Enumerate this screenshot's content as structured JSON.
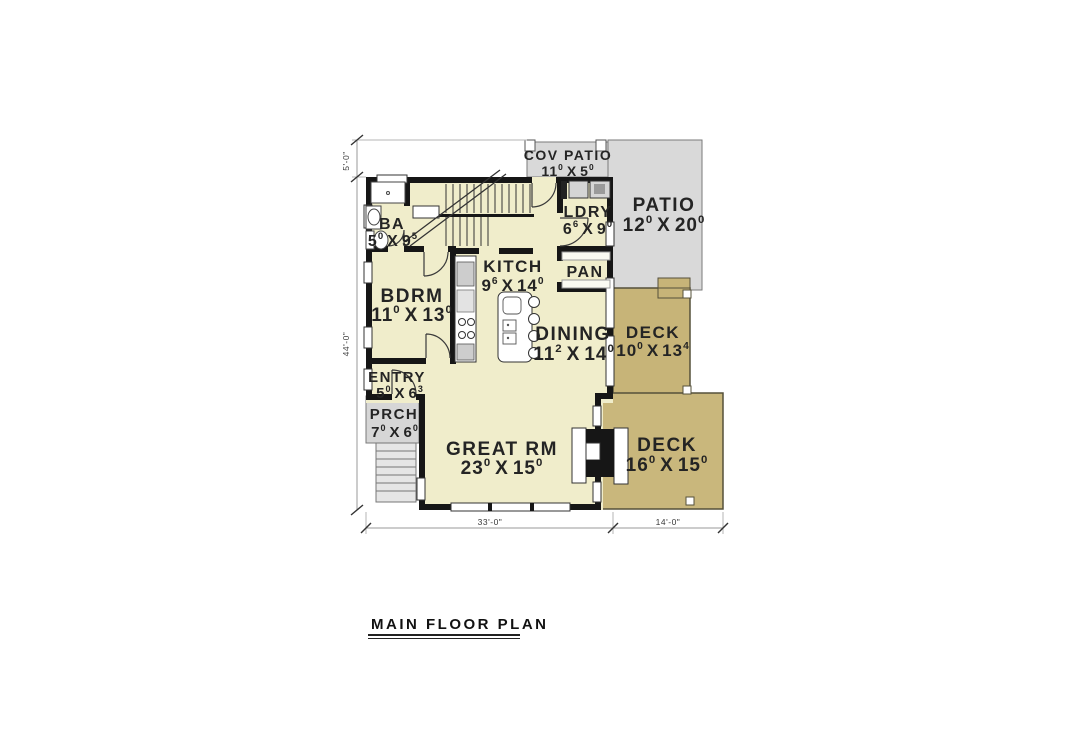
{
  "title": {
    "label": "MAIN FLOOR PLAN"
  },
  "rooms": {
    "cov_patio": {
      "name": "COV PATIO",
      "dim": {
        "w": "11",
        "ws": "0",
        "sep": "X",
        "h": "5",
        "hs": "0"
      }
    },
    "patio": {
      "name": "PATIO",
      "dim": {
        "w": "12",
        "ws": "0",
        "sep": "X",
        "h": "20",
        "hs": "0"
      }
    },
    "ba": {
      "name": "BA",
      "dim": {
        "w": "5",
        "ws": "0",
        "sep": "X",
        "h": "9",
        "hs": "5"
      }
    },
    "ldry": {
      "name": "LDRY",
      "dim": {
        "w": "6",
        "ws": "6",
        "sep": "X",
        "h": "9",
        "hs": "0"
      }
    },
    "kitch": {
      "name": "KITCH",
      "dim": {
        "w": "9",
        "ws": "6",
        "sep": "X",
        "h": "14",
        "hs": "0"
      }
    },
    "pan": {
      "name": "PAN"
    },
    "bdrm": {
      "name": "BDRM",
      "dim": {
        "w": "11",
        "ws": "0",
        "sep": "X",
        "h": "13",
        "hs": "0"
      }
    },
    "dining": {
      "name": "DINING",
      "dim": {
        "w": "11",
        "ws": "2",
        "sep": "X",
        "h": "14",
        "hs": "0"
      }
    },
    "deck_upper": {
      "name": "DECK",
      "dim": {
        "w": "10",
        "ws": "0",
        "sep": "X",
        "h": "13",
        "hs": "4"
      }
    },
    "entry": {
      "name": "ENTRY",
      "dim": {
        "w": "5",
        "ws": "0",
        "sep": "X",
        "h": "6",
        "hs": "3"
      }
    },
    "prch": {
      "name": "PRCH",
      "dim": {
        "w": "7",
        "ws": "0",
        "sep": "X",
        "h": "6",
        "hs": "0"
      }
    },
    "great_rm": {
      "name": "GREAT RM",
      "dim": {
        "w": "23",
        "ws": "0",
        "sep": "X",
        "h": "15",
        "hs": "0"
      }
    },
    "deck_lower": {
      "name": "DECK",
      "dim": {
        "w": "16",
        "ws": "0",
        "sep": "X",
        "h": "15",
        "hs": "0"
      }
    }
  },
  "dims": {
    "top_left": "5'-0\"",
    "left": "44'-0\"",
    "bottom_main": "33'-0\"",
    "bottom_deck": "14'-0\""
  },
  "colors": {
    "floor": "#f0edcb",
    "wall": "#161616",
    "patio": "#d9d9d9",
    "porch": "#d6d6d6",
    "deck": "#c7b478",
    "label_text": "#242424"
  }
}
